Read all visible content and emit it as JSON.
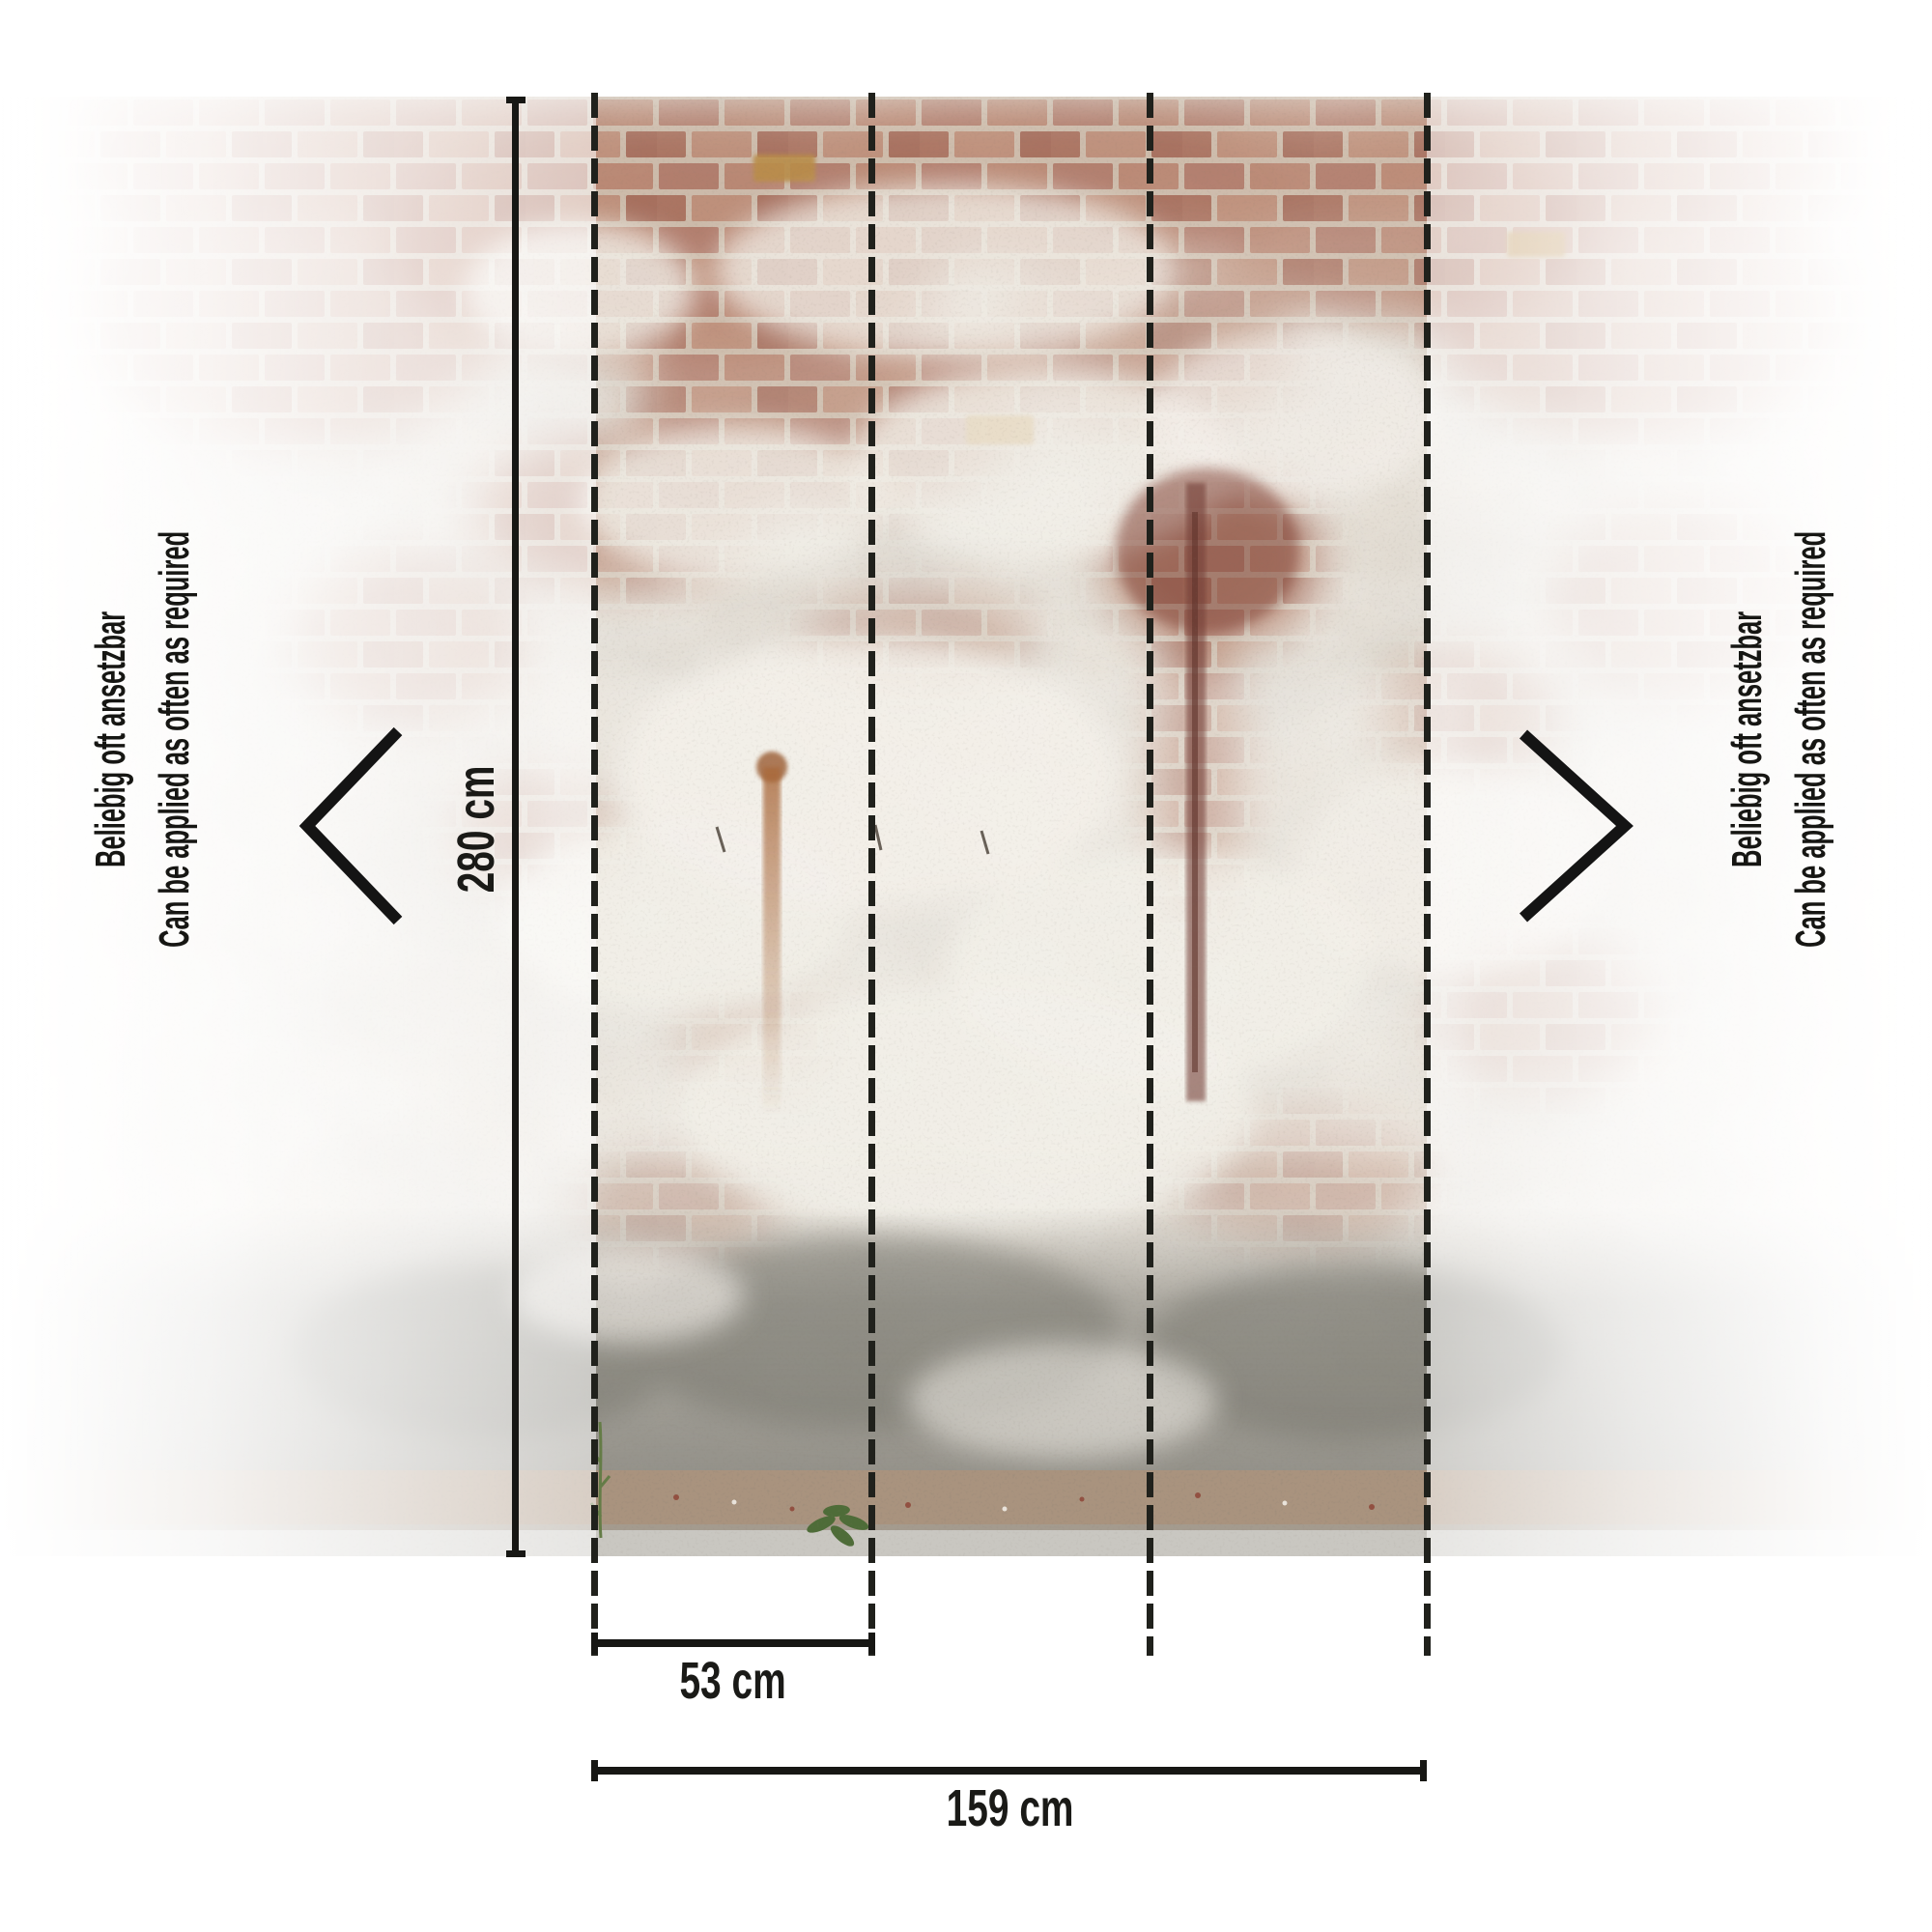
{
  "dimensions": {
    "height_label": "280 cm",
    "panel_width_label": "53 cm",
    "total_width_label": "159 cm"
  },
  "side_note_left": {
    "german": "Beliebig oft ansetzbar",
    "english": "Can be applied as often as required"
  },
  "side_note_right": {
    "german": "Beliebig oft ansetzbar",
    "english": "Can be applied as often as required"
  },
  "icons": {
    "left_repeat": "chevron-left",
    "right_repeat": "chevron-right"
  },
  "colors": {
    "annotation_black": "#171714",
    "background_white": "#ffffff",
    "plaster_light": "#ece8e1",
    "brick_red": "#a2604e",
    "brick_dark": "#7d4237",
    "ochre_brick": "#bd8f55",
    "rust_stain": "#a9683a",
    "concrete_gray": "#8e8b83",
    "pavement_gray": "#c9c7c1",
    "weed_green": "#4f7036"
  }
}
